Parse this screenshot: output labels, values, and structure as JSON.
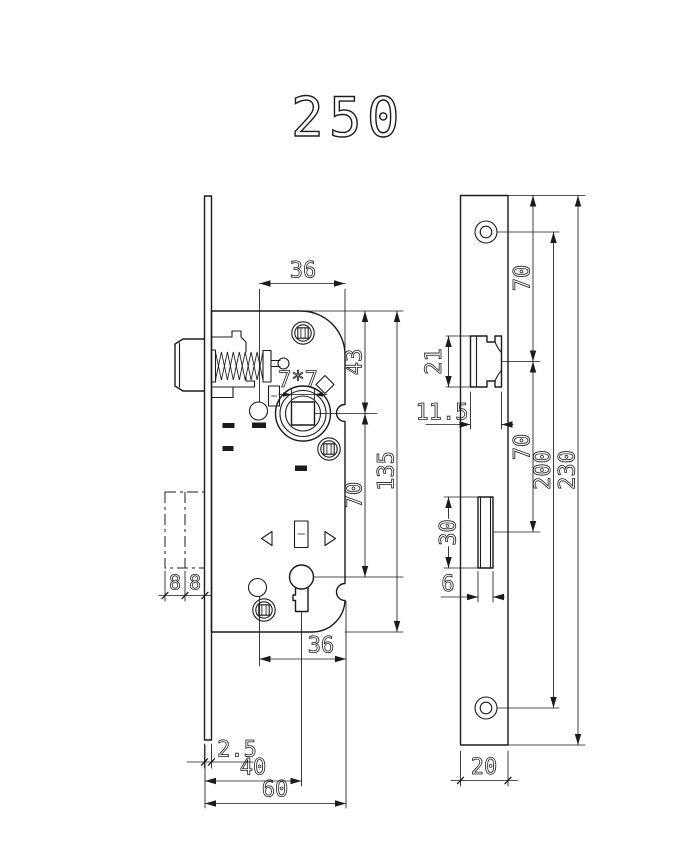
{
  "title": "250",
  "colors": {
    "line": "#1b1b1b",
    "background": "#ffffff"
  },
  "side_view": {
    "dim_width_top": "36",
    "dim_hub": "7*7",
    "dim_43": "43",
    "dim_70": "70",
    "dim_135": "135",
    "dim_bolt_left": "8",
    "dim_bolt_right": "8",
    "dim_width_bottom": "36",
    "dim_plate_thickness": "2.5",
    "dim_backset": "40",
    "dim_depth": "60"
  },
  "front_view": {
    "dim_latch_height": "21",
    "dim_latch_width": "11.5",
    "dim_top_to_latch": "70",
    "dim_latch_to_bolt": "70",
    "dim_screw_spacing": "200",
    "dim_plate_height": "230",
    "dim_bolt_height": "30",
    "dim_bolt_width": "6",
    "dim_plate_width": "20"
  }
}
